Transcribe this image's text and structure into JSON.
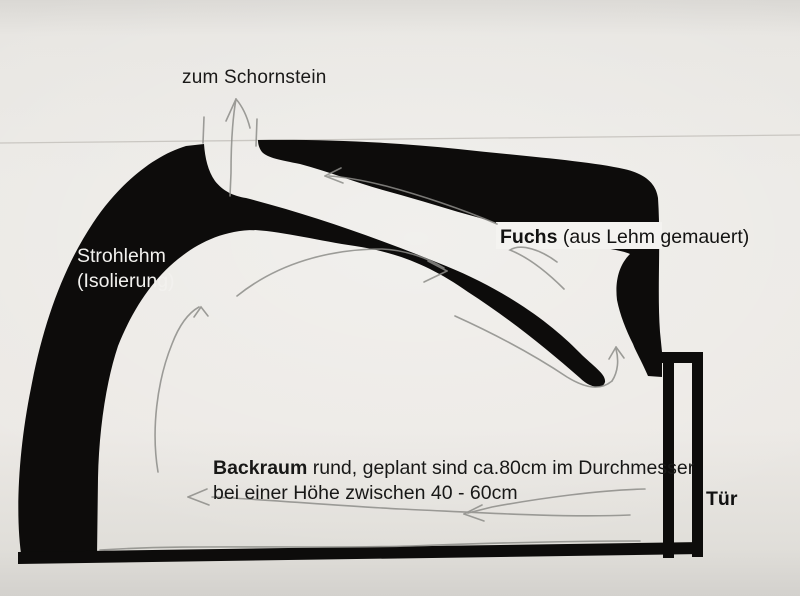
{
  "sketch": {
    "labels": {
      "chimney": "zum Schornstein",
      "insulation_line1": "Strohlehm",
      "insulation_line2": "(Isolierung)",
      "flue_term": "Fuchs",
      "flue_desc": "(aus Lehm gemauert)",
      "chamber_term": "Backraum",
      "chamber_desc": "rund, geplant sind ca.80cm im Durchmesser",
      "chamber_line2": "bei einer Höhe zwischen 40 - 60cm",
      "door": "Tür"
    },
    "colors": {
      "ink": "#0d0c0b",
      "paper": "#eae8e4",
      "pencil": "#8d8d89",
      "insulation_text": "#f2f1ee",
      "label_highlight": "#f4f3f0"
    }
  }
}
